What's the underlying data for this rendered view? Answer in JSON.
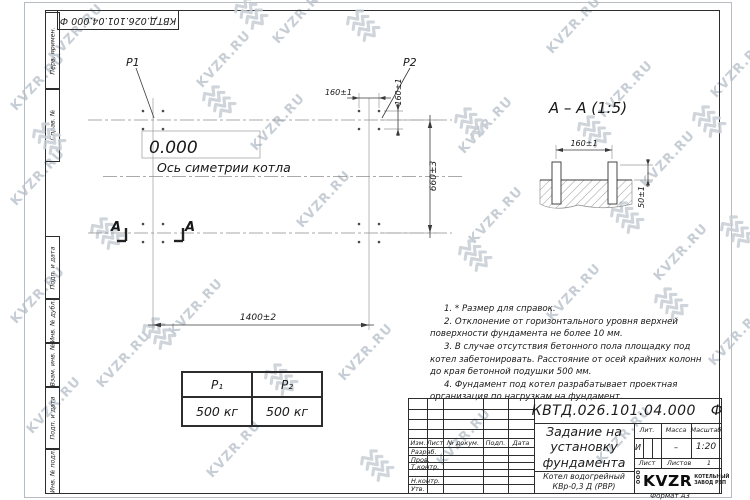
{
  "watermark": {
    "text": "KVZR.RU"
  },
  "stamp": {
    "doc_number": "КВТД.026.101.04.000 Ф"
  },
  "frame": {
    "labels": [
      "Перв. примен.",
      "Справ. №",
      "Подп. и дата",
      "Инв. № дубл.",
      "Взам. инв. №",
      "Подп. и дата",
      "Инв. № подл."
    ],
    "format_label": "Формат А3"
  },
  "plan": {
    "p1_label": "P1",
    "p2_label": "P2",
    "elevation": "0.000",
    "symmetry_axis_label": "Ось симетрии котла",
    "dim_length": "1400±2",
    "dim_width": "660±3",
    "dim_bolt_spacing_x": "160±1",
    "dim_bolt_spacing_y": "160±1",
    "section_mark": "А"
  },
  "section_view": {
    "title": "А – А (1:5)",
    "dim_bolt_spacing": "160±1",
    "dim_protrusion": "50±1"
  },
  "notes": [
    "1. * Размер для справок.",
    "2. Отклонение от горизонтального уровня верхней поверхности фундамента не более 10 мм.",
    "3. В случае отсутствия бетонного пола площадку под котел забетонировать. Расстояние от осей крайних колонн до края бетонной подушки 500 мм.",
    "4. Фундамент под котел разрабатывает проектная организация по нагрузкам на фундамент."
  ],
  "load_table": {
    "col1_header": "P₁",
    "col2_header": "P₂",
    "col1_value": "500 кг",
    "col2_value": "500 кг"
  },
  "title_block": {
    "doc_number": "КВТД.026.101.04.000   Ф",
    "title_line1": "Задание на",
    "title_line2": "установку",
    "title_line3": "фундамента",
    "product_line1": "Котел водогрейный",
    "product_line2": "КВр-0,3 Д (РВР)",
    "col_izm": "Изм.",
    "col_list": "Лист",
    "col_doc": "№ докум.",
    "col_podp": "Подп.",
    "col_data": "Дата",
    "row_razrab": "Разраб.",
    "row_prov": "Пров.",
    "row_tkontr": "Т.контр.",
    "row_nkontr": "Н.контр.",
    "row_utv": "Утв.",
    "lit_label": "Лит.",
    "lit_value": "И",
    "mass_label": "Масса",
    "mass_value": "–",
    "scale_label": "Масштаб",
    "scale_value": "1:20",
    "sheet_label": "Лист",
    "sheets_label": "Листов",
    "sheets_value": "1",
    "company_ooo": "ООО",
    "company_name": "KVZR",
    "company_line1": "КОТЕЛЬНЫЙ",
    "company_line2": "ЗАВОД РЭП"
  }
}
